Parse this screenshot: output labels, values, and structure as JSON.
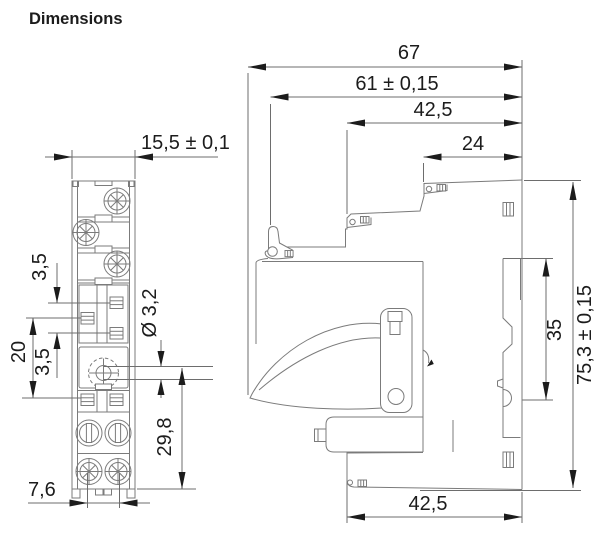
{
  "title": "Dimensions",
  "front_view": {
    "width": "15,5 ± 0,1",
    "contact_pitch_upper": "3,5",
    "contact_span": "20",
    "contact_pitch_lower": "3,5",
    "hole_diameter": "Ø 3,2",
    "hole_to_bottom": "29,8",
    "screw_spacing": "7,6"
  },
  "side_view": {
    "total_depth": "67",
    "body_depth": "61 ± 0,15",
    "upper_depth": "42,5",
    "top_section_depth": "24",
    "din_rail_height": "35",
    "total_height": "75,3 ± 0,15",
    "lower_depth": "42,5"
  },
  "colors": {
    "background": "#ffffff",
    "line": "#7b7b7b",
    "dimension_line": "#6d6d6d",
    "text": "#1c1c1c"
  }
}
